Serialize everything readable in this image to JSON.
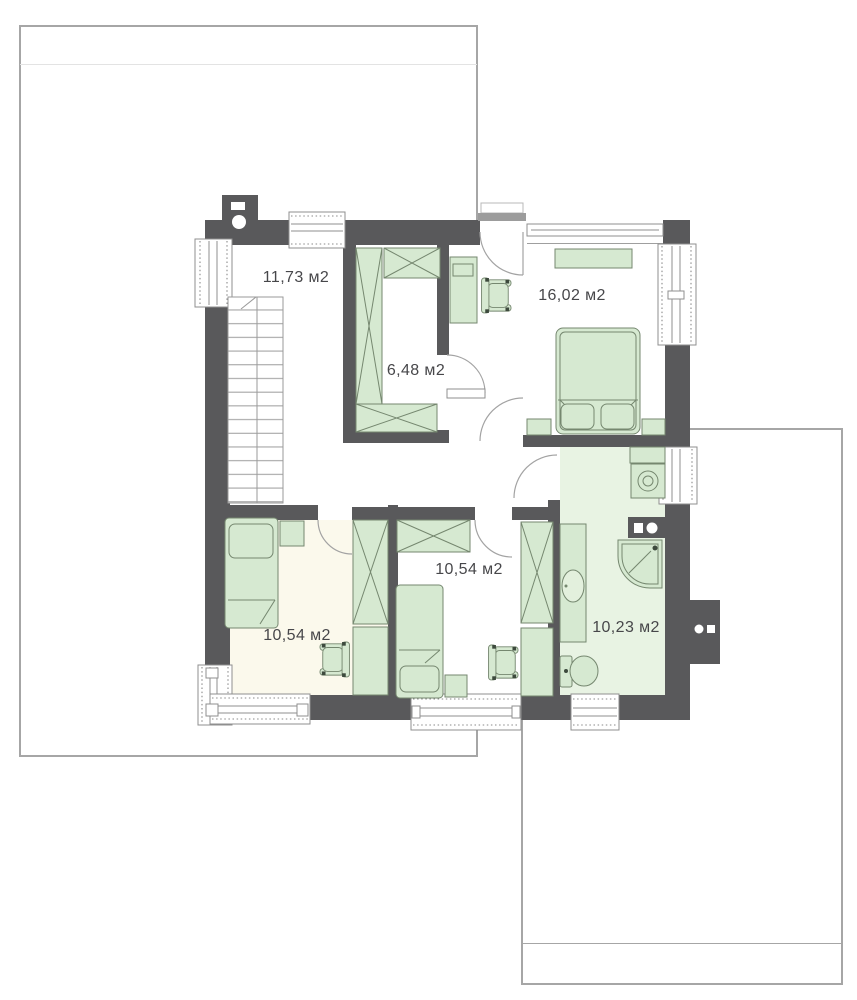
{
  "plan": {
    "unit": "м2",
    "rooms": [
      {
        "id": "hall-stairs",
        "area_label": "11,73 м2"
      },
      {
        "id": "closet",
        "area_label": "6,48 м2"
      },
      {
        "id": "bedroom-top-right",
        "area_label": "16,02 м2"
      },
      {
        "id": "bedroom-bottom-left",
        "area_label": "10,54 м2"
      },
      {
        "id": "bedroom-bottom-middle",
        "area_label": "10,54 м2"
      },
      {
        "id": "bathroom",
        "area_label": "10,23 м2"
      }
    ],
    "fixture_icons": [
      "stairs-icon",
      "double-bed-icon",
      "single-bed-icon",
      "wardrobe-icon",
      "desk-icon",
      "office-chair-icon",
      "shelf-icon",
      "nightstand-icon",
      "washing-machine-icon",
      "shower-icon",
      "washbasin-icon",
      "toilet-icon",
      "chimney-icon",
      "window-icon",
      "door-arc-icon"
    ],
    "colors": {
      "wall": "#59595b",
      "furniture_fill": "#d6e9d1",
      "furniture_stroke": "#75876f",
      "bathroom_floor": "#e8f3e3",
      "bedroom_left_floor": "#fbf9ec",
      "roof_outline": "#a6a6a6",
      "label_text": "#47474a",
      "window_frame": "#8f8f8f"
    }
  }
}
